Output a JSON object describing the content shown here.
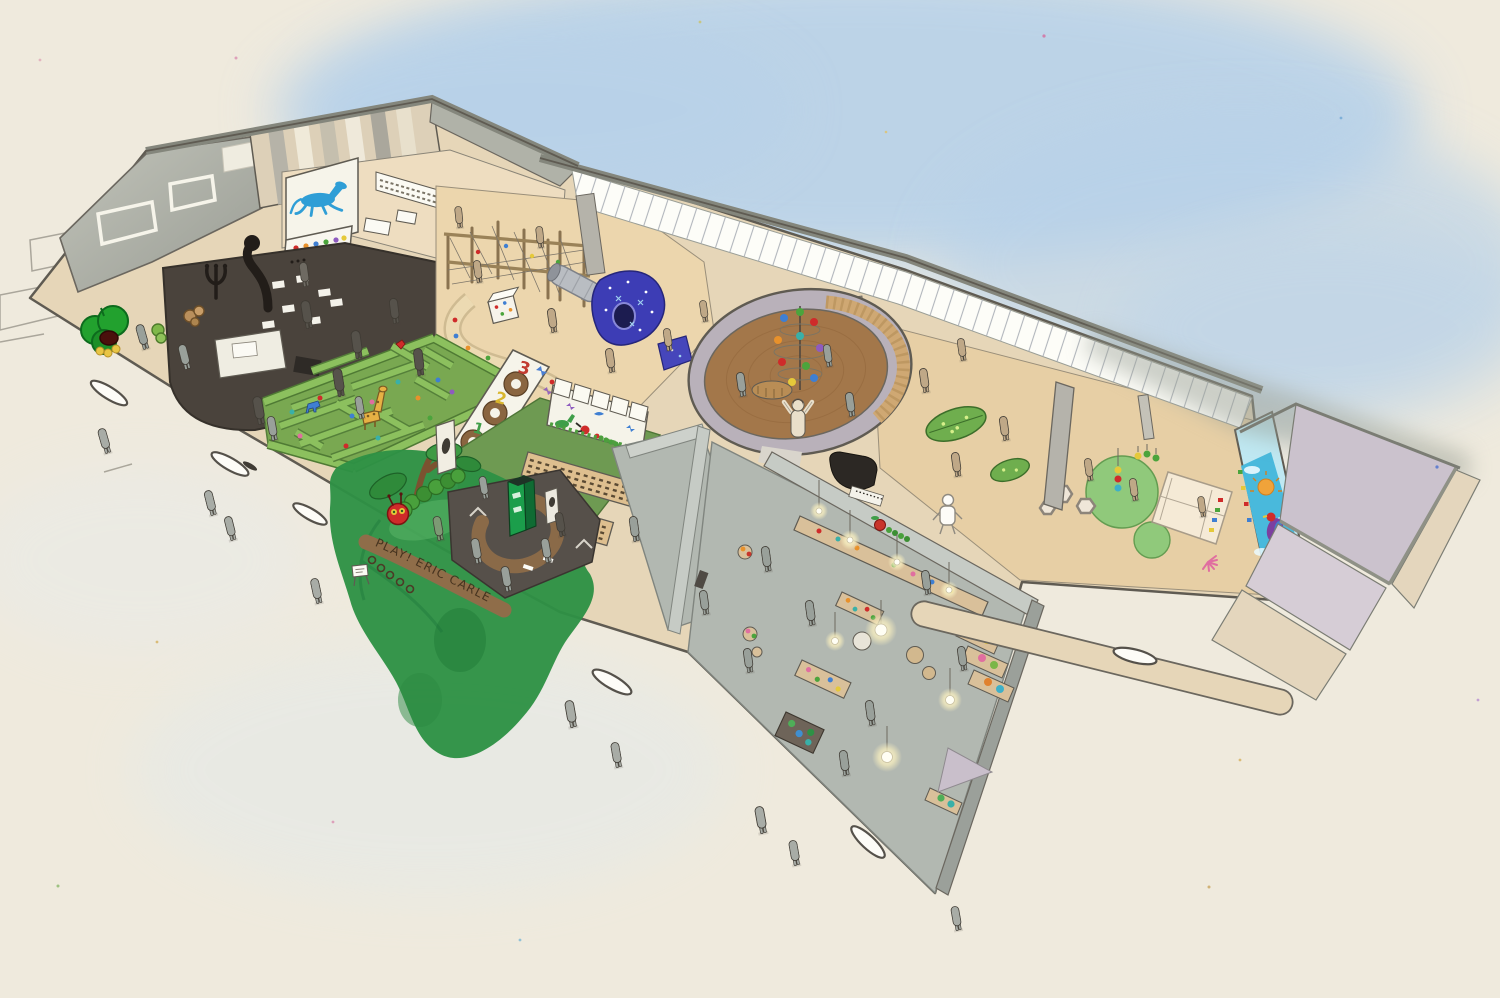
{
  "scene": {
    "description": "Hand-drawn isometric cutaway concept illustration of a children's museum play space",
    "signage": {
      "entrance_sign": "PLAY! ERIC CARLE"
    },
    "number_wall": {
      "numbers": [
        "1",
        "2",
        "3"
      ]
    },
    "regions": [
      "roof-slab",
      "striped-wall",
      "library-room",
      "blue-horse-mural",
      "polka-dot-wall",
      "dark-stage-room",
      "apple-tree-sculpture",
      "climbing-structure",
      "tunnel-slide",
      "starry-tunnel",
      "winding-ramp",
      "glass-curtain-wall",
      "hedge-maze",
      "number-wall",
      "book-nook",
      "animal-mural-wall",
      "caterpillar-garden",
      "entrance-desk",
      "round-reading-room",
      "ball-mobile",
      "leaf-seats",
      "toddler-zone",
      "ocean-mural-wall",
      "art-studio",
      "empty-studio",
      "adjacent-roofs",
      "exterior-walkway",
      "visitor-figures"
    ],
    "palette": {
      "paper": "#efeadd",
      "sky_wash": "#b7d1e9",
      "ink": "#5f5b52",
      "wall_beige": "#e6d6b8",
      "wall_white": "#f6f4ea",
      "roof_gray": "#aeb0a6",
      "glazing_white": "#fdfdf8",
      "floor_tan": "#ecd6ad",
      "floor_wood": "#e7cfa5",
      "stage_dark": "#4a433c",
      "maze_floor": "#79a851",
      "hedge_green": "#8cc05e",
      "grass_green": "#2e9145",
      "round_wall": "#b9b1ba",
      "round_wood": "#cfa873",
      "round_floor": "#a3774a",
      "studio_floor": "#b2b8b1",
      "studio_wall": "#c6cbc5",
      "counter_wood": "#d9c09a",
      "desk_brown": "#8a6a48",
      "desk_floor": "#56504a",
      "kiosk_green": "#1b9e4b",
      "lavender_roof": "#cbc2cd",
      "mural_sky": "#bfe8f2",
      "mural_water": "#49b9dc",
      "horse_blue": "#2f9ed6",
      "apple_green": "#22a12e",
      "caterpillar_green": "#49a03c",
      "caterpillar_red": "#cf2b2a",
      "figure_gray": "#99a09a",
      "figure_dark": "#56524b",
      "figure_tan": "#bfa887",
      "child_cream": "#e9dfca",
      "lamp_glow": "#fff6d2",
      "sun_orange": "#f0a33a",
      "accent_red": "#cf2b2a",
      "accent_orange": "#e8912b",
      "accent_yellow": "#e5c93a",
      "accent_green": "#4ba43c",
      "accent_blue": "#3f7fd2",
      "accent_purple": "#8e5bbf",
      "accent_teal": "#39b0a8",
      "accent_pink": "#e06ea0"
    }
  }
}
